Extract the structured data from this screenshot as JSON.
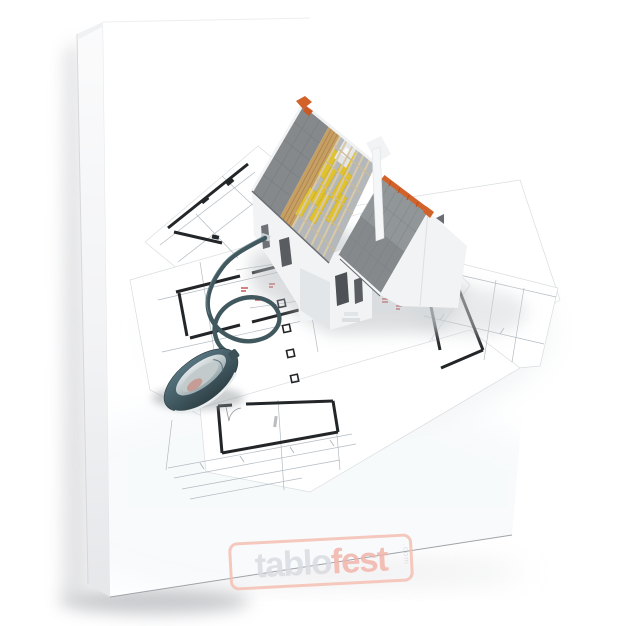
{
  "product": {
    "type_label": "canvas-print-product-photo",
    "background_color": "#ffffff",
    "canvas_side_color": "#ebecee",
    "canvas_edge_line_color": "#9fa3a7"
  },
  "artwork": {
    "description": "3D rendered house under construction (roof partly open showing rafters and insulation) standing on architectural floor-plan blueprints, with a computer mouse connected to the house by a looping cable",
    "objects": [
      "house-model",
      "blueprint-sheets",
      "computer-mouse",
      "mouse-cable"
    ],
    "colors": {
      "roof_shingles": "#85898c",
      "roof_shingles_right": "#8e9396",
      "roof_ridge": "#d2622a",
      "wood_planks": "#c79f63",
      "insulation": "#e0c22e",
      "rafter_wood": "#d9c9a7",
      "walls": "#f1f3f5",
      "blueprint_paper": "#ffffff",
      "blueprint_wall": "#232628",
      "blueprint_line": "#aab3ba",
      "blueprint_mark": "#c03030",
      "mouse_body": "#44595f",
      "mouse_panel": "#ccd3d5",
      "mouse_accent": "#c7958c",
      "mouse_cable": "#41585f"
    }
  },
  "watermark": {
    "text_primary": "tablo",
    "text_secondary": "fest",
    "text_suffix": ".com",
    "color_primary": "#d9dce1",
    "color_secondary": "#f2b5ac",
    "border_color": "#f5c0b4"
  }
}
